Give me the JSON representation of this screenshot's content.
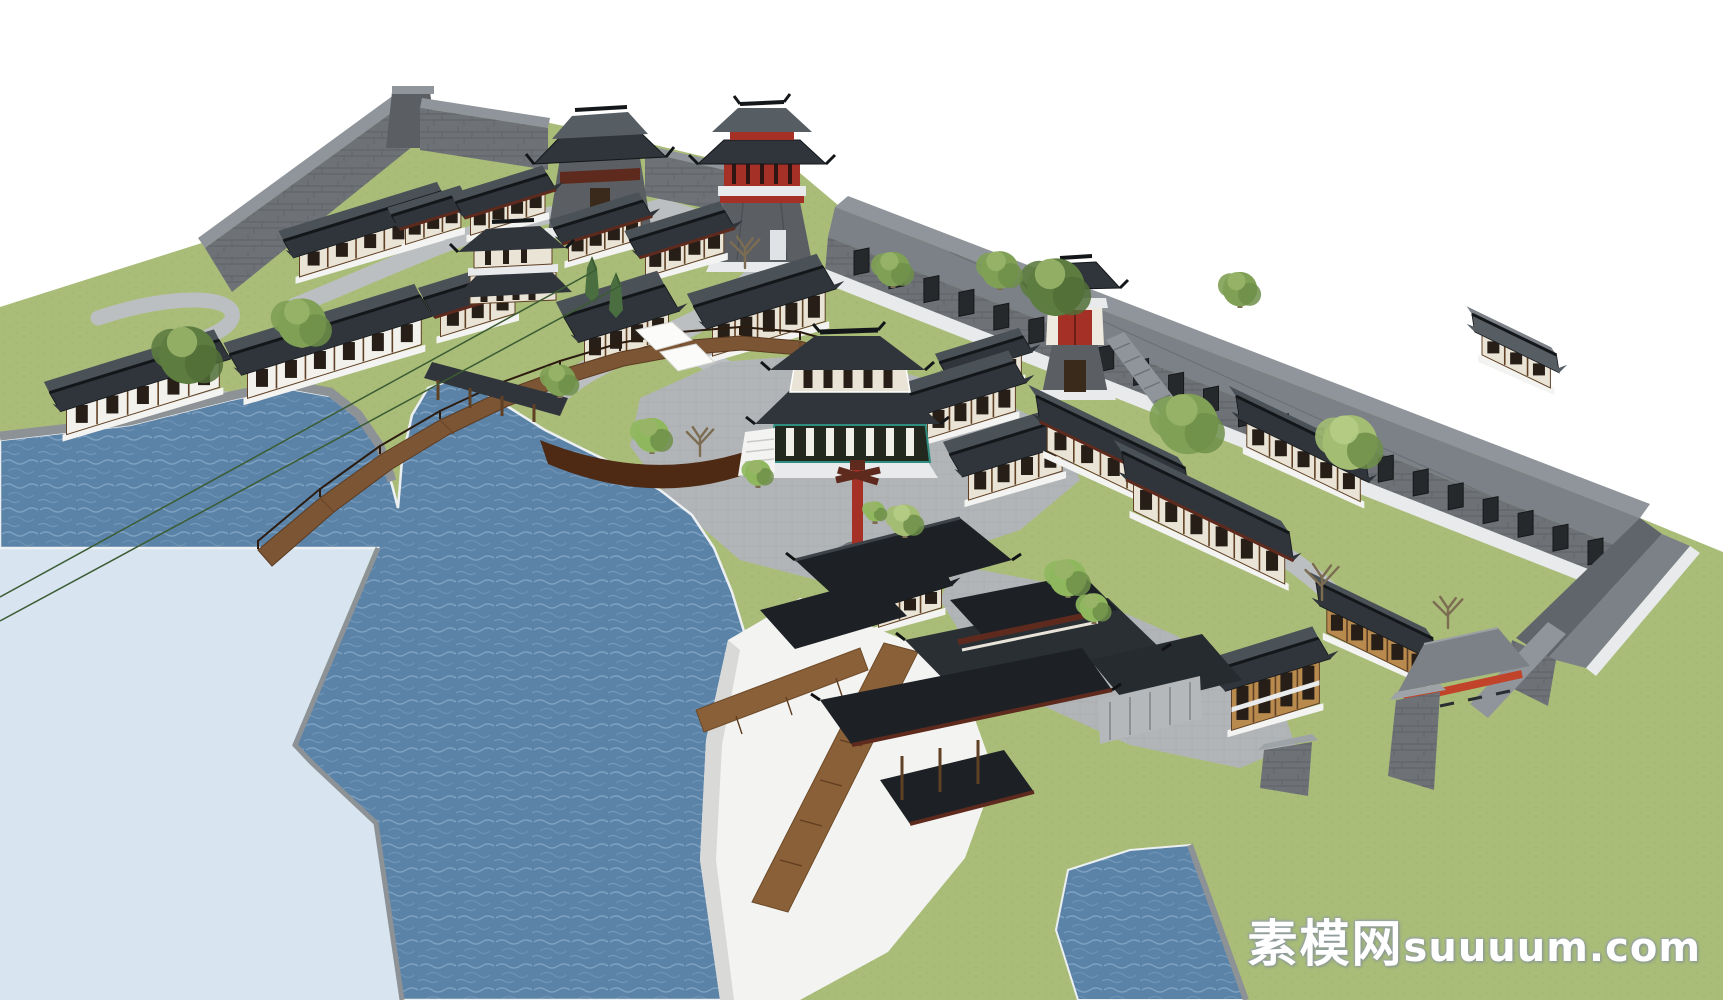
{
  "title": "Chinese ancient town waterfront complex - 3D model render",
  "watermark": {
    "cn": "素模网",
    "latin": "suuuum.com"
  },
  "colors": {
    "sky": "#ffffff",
    "grass": "#a9bd79",
    "grass_dot": "#9cb16b",
    "water": "#5b83a8",
    "water_light": "#8fb0cc",
    "water_pale": "#d8e5f1",
    "shore": "#ecf0f2",
    "embankment": "#8d9296",
    "path": "#bcbfc1",
    "plaza": "#b2b5b7",
    "stone": "#6e7276",
    "stone_dark": "#5b5f63",
    "stone_light": "#8f959a",
    "roof_black": "#1d2125",
    "roof_dark": "#2f353a",
    "roof_mid": "#565d63",
    "roof_gray": "#7b8186",
    "roof_back": "#4a5157",
    "coping": "#e8eaec",
    "wall_cream": "#eae4d6",
    "wall_white": "#f2f1ec",
    "wall_timber": "#b98a4e",
    "timber": "#5f4024",
    "timber_dark": "#3a2a1c",
    "window": "#271f17",
    "red": "#a43026",
    "maroon": "#5f2a1e",
    "teal": "#2f8d7f",
    "bridge_wood": "#7c5534",
    "bridge_dark": "#4e2a15",
    "plank": "#8a6038",
    "platform": "#f3f3f1",
    "platform_side": "#d9d9d7",
    "tree_green": "#7fa055",
    "tree_dark": "#5d7c40",
    "tree_light": "#a3bd72",
    "tree_bright": "#8fb85e",
    "trunk": "#7c6c52",
    "cypress": "#4a6e3f",
    "watermark": "#ffffff"
  },
  "scene": {
    "elements": [
      "sky",
      "grass-terrain",
      "lake-water",
      "outer-pale-water",
      "stone-embankment",
      "walking-paths",
      "central-plaza",
      "city-wall",
      "left-gate-tower",
      "central-gate-tower",
      "red-gate-tower",
      "wall-corridor-building",
      "corridor-corner-wing",
      "arched-wooden-bridge",
      "covered-gallery",
      "central-two-story-pavilion",
      "west-two-story-pavilion",
      "waterfront-pavilion-complex",
      "white-platform",
      "wooden-pier",
      "red-totem-pole",
      "white-awnings",
      "bottom-right-gate-pavilion",
      "battered-corner-towers",
      "houses",
      "trees",
      "watermark"
    ],
    "corridor": {
      "windows": 22
    },
    "houses": [
      {
        "name": "gallery-house-nw",
        "orient": "ne",
        "rx": 292,
        "ry": 238,
        "len": 148,
        "dep": 20,
        "wh": 26,
        "roof": "dark",
        "wall": "cream",
        "win": 5
      },
      {
        "name": "court-house-w",
        "orient": "ne",
        "rx": 400,
        "ry": 213,
        "len": 58,
        "dep": 16,
        "wh": 22,
        "roof": "dark",
        "wall": "cream",
        "win": 3,
        "fascia": true
      },
      {
        "name": "court-house-m",
        "orient": "ne",
        "rx": 464,
        "ry": 200,
        "len": 78,
        "dep": 18,
        "wh": 24,
        "roof": "dark",
        "wall": "cream",
        "win": 4,
        "fascia": true
      },
      {
        "name": "court-house-e",
        "orient": "ne",
        "rx": 562,
        "ry": 226,
        "len": 76,
        "dep": 18,
        "wh": 24,
        "roof": "dark",
        "wall": "cream",
        "win": 4,
        "fascia": true
      },
      {
        "name": "court-house-s",
        "orient": "ne",
        "rx": 638,
        "ry": 238,
        "len": 82,
        "dep": 20,
        "wh": 26,
        "roof": "dark",
        "wall": "cream",
        "win": 4,
        "fascia": true
      },
      {
        "name": "plaza-north-house",
        "orient": "ne",
        "rx": 702,
        "ry": 304,
        "len": 118,
        "dep": 26,
        "wh": 34,
        "roof": "dark",
        "wall": "cream",
        "win": 5
      },
      {
        "name": "east-house-c",
        "orient": "ne",
        "rx": 948,
        "ry": 360,
        "len": 70,
        "dep": 18,
        "wh": 24,
        "roof": "dark",
        "wall": "cream",
        "win": 3
      },
      {
        "name": "east-house-a",
        "orient": "ne",
        "rx": 918,
        "ry": 392,
        "len": 92,
        "dep": 24,
        "wh": 30,
        "roof": "dark",
        "wall": "cream",
        "win": 4
      },
      {
        "name": "east-house-b",
        "orient": "ne",
        "rx": 958,
        "ry": 452,
        "len": 98,
        "dep": 26,
        "wh": 30,
        "roof": "dark",
        "wall": "cream",
        "win": 4
      },
      {
        "name": "shore-house-west",
        "orient": "ne",
        "rx": 58,
        "ry": 390,
        "len": 160,
        "dep": 22,
        "wh": 30,
        "roof": "dark",
        "wall": "white",
        "win": 5
      },
      {
        "name": "shore-house-east",
        "orient": "ne",
        "rx": 238,
        "ry": 352,
        "len": 182,
        "dep": 24,
        "wh": 30,
        "roof": "dark",
        "wall": "white",
        "win": 6
      },
      {
        "name": "pagoda-house",
        "orient": "ne",
        "rx": 432,
        "ry": 296,
        "len": 78,
        "dep": 22,
        "wh": 26,
        "roof": "dark",
        "wall": "cream",
        "win": 3,
        "fascia": true
      },
      {
        "name": "west-big-house",
        "orient": "ne",
        "rx": 572,
        "ry": 314,
        "len": 88,
        "dep": 30,
        "wh": 30,
        "roof": "dark",
        "wall": "cream",
        "win": 4
      },
      {
        "name": "right-complex-north",
        "orient": "se",
        "rx": 1044,
        "ry": 400,
        "len": 148,
        "dep": 26,
        "wh": 30,
        "roof": "dark",
        "wall": "cream",
        "win": 5,
        "fascia": true
      },
      {
        "name": "right-complex-east",
        "orient": "se",
        "rx": 1244,
        "ry": 400,
        "len": 126,
        "dep": 24,
        "wh": 28,
        "roof": "dark",
        "wall": "cream",
        "win": 5
      },
      {
        "name": "right-complex-south",
        "orient": "se",
        "rx": 1130,
        "ry": 456,
        "len": 168,
        "dep": 28,
        "wh": 32,
        "roof": "dark",
        "wall": "cream",
        "win": 6,
        "fascia": true
      },
      {
        "name": "far-right-wall-house",
        "orient": "se",
        "rx": 1480,
        "ry": 318,
        "len": 76,
        "dep": 18,
        "wh": 24,
        "roof": "mid",
        "wall": "cream",
        "win": 3
      },
      {
        "name": "br-long-house",
        "orient": "se",
        "rx": 1324,
        "ry": 586,
        "len": 112,
        "dep": 24,
        "wh": 28,
        "roof": "dark",
        "wall": "timber",
        "win": 5
      },
      {
        "name": "br-inn",
        "orient": "ne",
        "rx": 1222,
        "ry": 668,
        "len": 92,
        "dep": 24,
        "wh": 46,
        "roof": "dark",
        "wall": "timber",
        "win": 4,
        "story2": true
      },
      {
        "name": "waterfront-annex",
        "orient": "ne",
        "rx": 872,
        "ry": 592,
        "len": 66,
        "dep": 18,
        "wh": 24,
        "roof": "black",
        "wall": "cream",
        "win": 3
      }
    ],
    "trees": [
      {
        "x": 188,
        "y": 380,
        "r": 40,
        "kind": "dark"
      },
      {
        "x": 302,
        "y": 344,
        "r": 34,
        "kind": "green"
      },
      {
        "x": 560,
        "y": 394,
        "r": 22,
        "kind": "green"
      },
      {
        "x": 652,
        "y": 450,
        "r": 24,
        "kind": "bright"
      },
      {
        "x": 758,
        "y": 484,
        "r": 18,
        "kind": "bright"
      },
      {
        "x": 905,
        "y": 534,
        "r": 22,
        "kind": "light"
      },
      {
        "x": 1056,
        "y": 312,
        "r": 40,
        "kind": "dark"
      },
      {
        "x": 1000,
        "y": 286,
        "r": 26,
        "kind": "green"
      },
      {
        "x": 893,
        "y": 284,
        "r": 24,
        "kind": "green"
      },
      {
        "x": 1188,
        "y": 450,
        "r": 42,
        "kind": "green"
      },
      {
        "x": 1350,
        "y": 466,
        "r": 38,
        "kind": "light"
      },
      {
        "x": 1068,
        "y": 594,
        "r": 26,
        "kind": "bright"
      },
      {
        "x": 1094,
        "y": 620,
        "r": 20,
        "kind": "bright"
      },
      {
        "x": 875,
        "y": 520,
        "r": 14,
        "kind": "bright"
      },
      {
        "x": 1240,
        "y": 304,
        "r": 24,
        "kind": "green"
      },
      {
        "x": 592,
        "y": 302,
        "r": 15,
        "kind": "cypress"
      },
      {
        "x": 616,
        "y": 318,
        "r": 15,
        "kind": "cypress"
      },
      {
        "x": 745,
        "y": 268,
        "r": 26,
        "kind": "bare"
      },
      {
        "x": 700,
        "y": 456,
        "r": 24,
        "kind": "bare"
      },
      {
        "x": 1322,
        "y": 600,
        "r": 30,
        "kind": "bare"
      },
      {
        "x": 1448,
        "y": 628,
        "r": 26,
        "kind": "bare"
      }
    ]
  }
}
